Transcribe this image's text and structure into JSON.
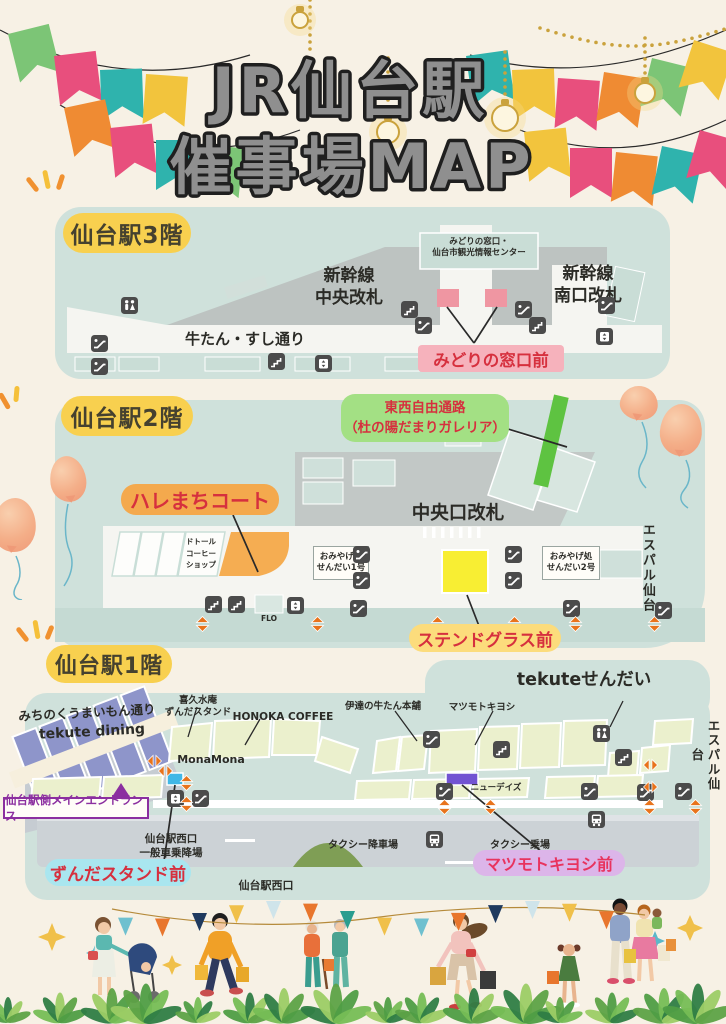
{
  "title": {
    "line1": "JR仙台駅",
    "line2": "催事場MAP"
  },
  "floor3": {
    "badge": "仙台駅3階",
    "midori_info": "みどりの窓口・\n仙台市観光情報センター",
    "shinkansen_chuo": "新幹線\n中央改札",
    "shinkansen_minami": "新幹線\n南口改札",
    "gyutan_street": "牛たん・すし通り",
    "event_label": "みどりの窓口前"
  },
  "floor2": {
    "badge": "仙台駅2階",
    "tozai": "東西自由通路\n（杜の陽だまりガレリア）",
    "halemachi": "ハレまちコート",
    "doutor": "ドトール\nコーヒー\nショップ",
    "omiyage1": "おみやげ処\nせんだい1号",
    "chuo_gate": "中央口改札",
    "omiyage2": "おみやげ処\nせんだい2号",
    "flo": "FLO",
    "espal": "エスパル仙台",
    "stained_glass": "ステンドグラス前"
  },
  "floor1": {
    "badge": "仙台駅1階",
    "michinoku": "みちのくうまいもん通り",
    "tekute_dining": "tekute dining",
    "kikusuian": "喜久水庵\nずんだスタンド",
    "honoka": "HONOKA COFFEE",
    "monamona": "MonaMona",
    "date_gyutan": "伊達の牛たん本舗",
    "matsumotokiyoshi": "マツモトキヨシ",
    "tekute_sendai": "tekuteせんだい",
    "newdays": "ニューデイズ",
    "espal": "エスパル仙台",
    "main_entrance": "仙台駅側メインエントランス",
    "west_general": "仙台駅西口\n一般車乗降場",
    "taxi_drop": "タクシー降車場",
    "taxi_stand": "タクシー乗場",
    "west_exit": "仙台駅西口",
    "zunda_label": "ずんだスタンド前",
    "matsukiyo_label": "マツモトキヨシ前"
  },
  "colors": {
    "background": "#f7f1e5",
    "map_panel": "#cfe1db",
    "badge_yellow": "#f8d04f",
    "event_pink": "#ef96a2",
    "label_pink_bg": "#f6b2bc",
    "event_green_bar": "#5ec341",
    "label_green_bg": "#a3e084",
    "event_orange_area": "#f5ad52",
    "label_orange_bg": "#f4a94d",
    "event_yellow": "#f8ee33",
    "label_yellow_bg": "#fcdc7c",
    "event_blue": "#41b7e6",
    "label_blue_bg": "#a9e6ef",
    "event_purple": "#7253d2",
    "label_purple_bg": "#dcb5e9",
    "highlight_text_red": "#d6303e",
    "entrance_purple": "#8b2fa0"
  },
  "icons": [
    "restroom-icon",
    "escalator-icon",
    "stairs-icon",
    "elevator-icon",
    "bus-icon",
    "updown-arrow-icon",
    "leftright-arrow-icon"
  ]
}
